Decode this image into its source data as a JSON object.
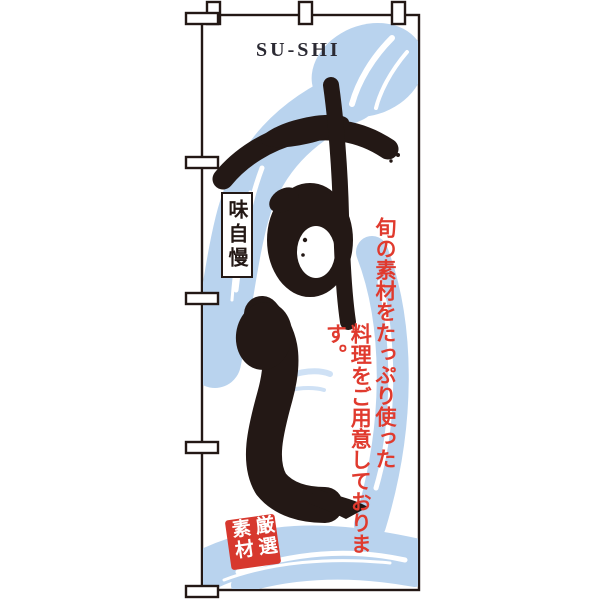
{
  "banner": {
    "title_en": "SU-SHI",
    "calligraphy": "すし",
    "badge": "味自慢",
    "tagline": {
      "column1": "旬の素材をたっぷり使った",
      "column2": "料理をご用意しております。"
    },
    "seal": "厳選素材",
    "colors": {
      "ink_black": "#231815",
      "brush_blue": "#b9d3ee",
      "accent_red": "#dd382d"
    }
  }
}
